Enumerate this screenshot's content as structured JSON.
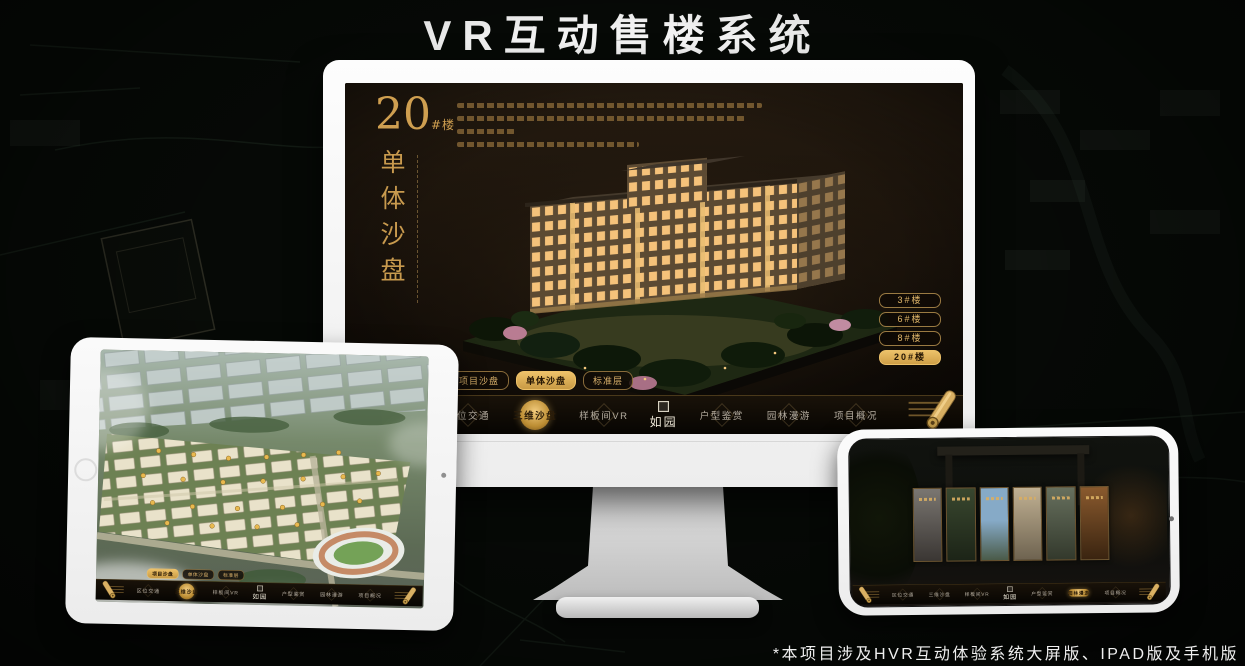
{
  "title": "VR互动售楼系统",
  "footnote": "*本项目涉及HVR互动体验系统大屏版、IPAD版及手机版",
  "colors": {
    "accent_gold": "#d9ae62",
    "active_gold_bg": "#e3b763",
    "screen_bg": "#140e08",
    "device_frame": "#f5f5f5"
  },
  "app": {
    "logo": "如园",
    "view_tabs": [
      "项目沙盘",
      "单体沙盘",
      "标准层"
    ],
    "nav_items": [
      "区位交通",
      "三维沙盘",
      "样板间VR",
      "户型鉴赏",
      "园林漫游",
      "项目概况"
    ],
    "single_view": {
      "number": "20",
      "number_suffix": "#楼",
      "subtitle": "单体沙盘",
      "floor_buttons": [
        "3#楼",
        "6#楼",
        "8#楼",
        "20#楼"
      ]
    }
  }
}
